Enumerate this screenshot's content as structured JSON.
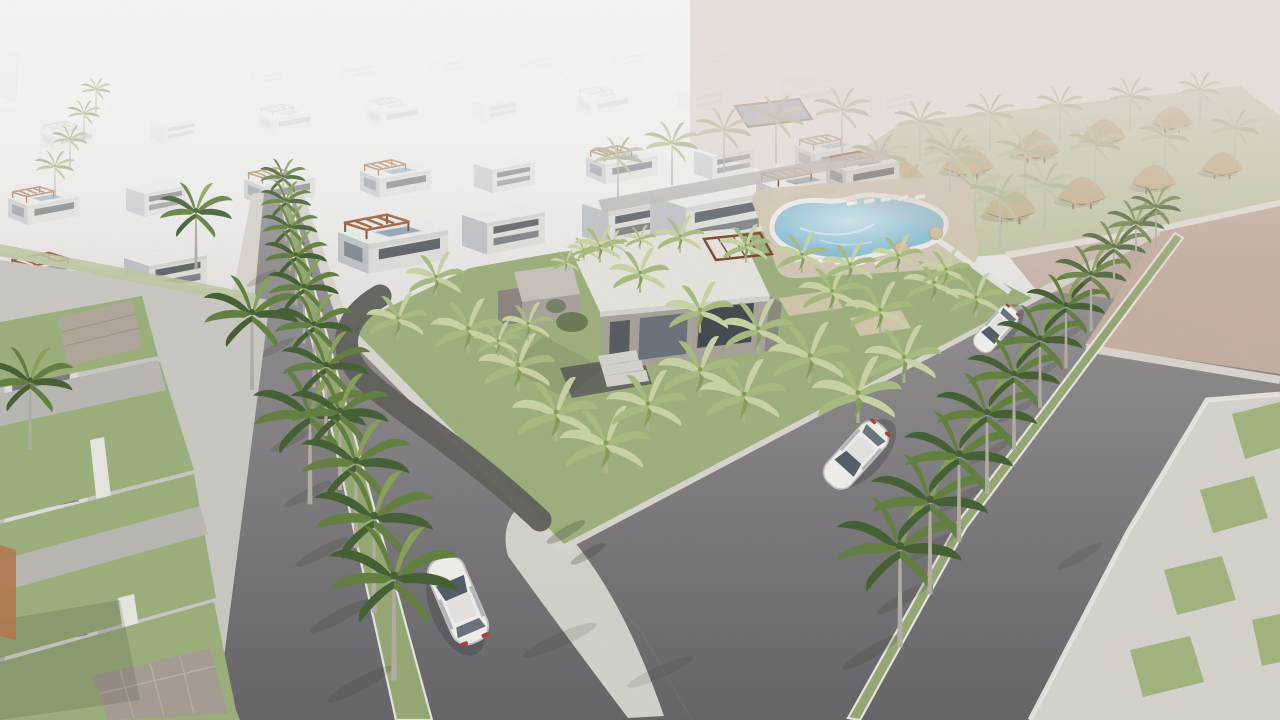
{
  "scene": {
    "title": "Residential masterplan aerial 3D render",
    "environment": "hazy bright daylight, desert coastal setting",
    "inventory": {
      "vehicles": {
        "count": 3,
        "description": "white sedans driving on the boulevards"
      },
      "swimming_pool": {
        "count": 1,
        "description": "freeform community pool with white rim, sun loungers and tan parasols"
      },
      "clubhouse": {
        "count": 1,
        "description": "flat-roof concrete clubhouse with dark glazing, entry steps and roof planting"
      },
      "cabanas": {
        "count": 10,
        "description": "thatched-roof cabanas on the hazy resort lawn behind the pool"
      },
      "street_palms": "royal palms planted in white-curbed grass medians along both boulevards",
      "park_palms": "pale banana palms scattered across the central triangular pocket park",
      "villas": "receding rows of white flat-roof villas with rooftop pools and timber pergolas fading into fog",
      "empty_lot": "unbuilt sandy parcel bounded by low white walls",
      "plaza": "light paved esplanade with inset grass squares at lower right",
      "gravel_path": "dark gravel walkway curving through the pocket park"
    }
  },
  "colors": {
    "sky_top": "#f2f0ee",
    "sky_mid": "#e2dfdd",
    "sky_low": "#d5d2d0",
    "desert_haze": "#d8c3b8",
    "sand": "#c9b2a3",
    "road": "#626165",
    "road_far": "#9e9a9c",
    "sidewalk": "#dedbd4",
    "curb": "#efede8",
    "grass": "#9db37b",
    "grass_hazy": "#c3cda6",
    "park_grass": "#9fb37c",
    "median_grass": "#96aa72",
    "plaza_grass": "#a3b77e",
    "plaza_pavement": "#dcd9d2",
    "palm_dark": "#3f5d2d",
    "palm_mid": "#5f7f3a",
    "palm_light": "#88a353",
    "palm_hazy_a": "#aebd90",
    "palm_hazy_b": "#c1cda4",
    "trunk": "#b5b0a6",
    "banana_light": "#cfd9a6",
    "banana_mid": "#aabf7f",
    "banana_dark": "#84a055",
    "banana_trunk": "#b2b890",
    "house_roof": "#f2f2f0",
    "house_parapet": "#d8d8d5",
    "house_front": "#e4e4e1",
    "house_side": "#c2c5c9",
    "window_dark": "#3e454d",
    "window_glass": "#64707b",
    "roof_pool": "#8ea6b8",
    "glass_canopy": "#93a9c2",
    "pergola": "#9b5730",
    "pergola_dark": "#7c4323",
    "concrete_light": "#ccc7bf",
    "concrete_mid": "#aaa49c",
    "concrete_dark": "#8a857e",
    "gravel": "#5e5d58",
    "pool_deck": "#d8ccb9",
    "pool_water": "#8ec5dc",
    "pool_shallow": "#d3eaf2",
    "pool_rim": "#f6f4ef",
    "hut_roof": "#cbb78a",
    "hut_dark": "#8d6d49",
    "canopy": "#d9cdb2",
    "umbrella": "#d6c4a4",
    "car_body": "#f8f7f5",
    "car_glass": "#4e5a66",
    "taillight": "#b23b2e",
    "stone_wall": "#b2a99c",
    "terracotta": "#b77748",
    "walkway_wall": "#bdbab4",
    "driveway": "#bdbbb6",
    "fog": "#ffffff"
  }
}
